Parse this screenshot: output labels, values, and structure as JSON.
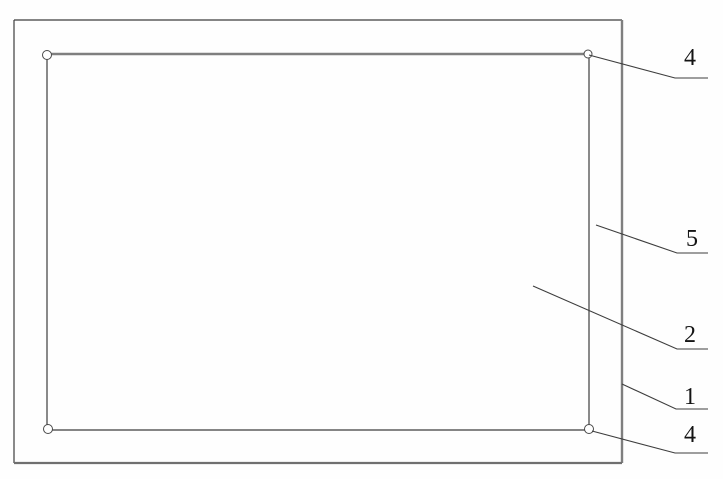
{
  "drawing": {
    "type": "technical-drawing",
    "callouts": [
      {
        "label": "4",
        "target": "panel-top-right-corner-pad"
      },
      {
        "label": "5",
        "target": "gap-between-panel-and-frame"
      },
      {
        "label": "2",
        "target": "inner-panel"
      },
      {
        "label": "1",
        "target": "outer-frame"
      },
      {
        "label": "4",
        "target": "panel-bottom-right-corner-pad"
      }
    ],
    "colors": {
      "thin_line": "#3d3d3d",
      "thick_line": "#7f7f7f",
      "label_text": "#141414",
      "background": "#fefefe"
    }
  }
}
